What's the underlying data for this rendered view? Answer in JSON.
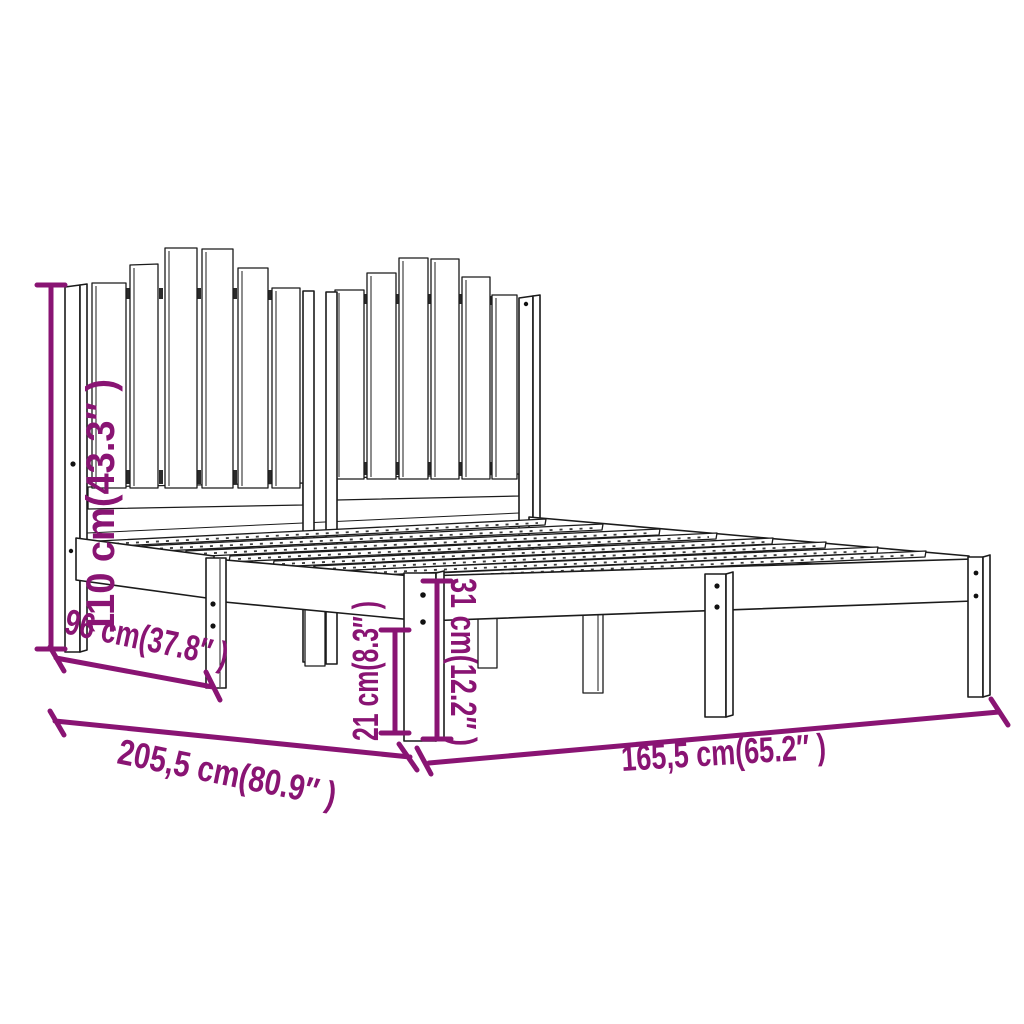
{
  "diagram": {
    "kind": "furniture-dimension-line-drawing",
    "subject": "wooden bed frame with two-section picket slat headboard",
    "background_color": "#ffffff",
    "outline_color": "#1b1b1b",
    "dimension_color": "#891473",
    "dimensions": {
      "headboard_height": {
        "label": "110 cm(43.3″ )",
        "cm": "110",
        "inches": "43.3",
        "orientation": "vertical-left"
      },
      "side_depth": {
        "label": "96 cm(37.8″ )",
        "cm": "96",
        "inches": "37.8",
        "orientation": "diagonal-lower-left"
      },
      "frame_length": {
        "label": "205,5 cm(80.9″ )",
        "cm": "205,5",
        "inches": "80.9",
        "orientation": "diagonal-bottom-left"
      },
      "leg_height": {
        "label": "21 cm(8.3″ )",
        "cm": "21",
        "inches": "8.3",
        "orientation": "vertical-center"
      },
      "platform_height": {
        "label": "31 cm(12.2″ )",
        "cm": "31",
        "inches": "12.2",
        "orientation": "vertical-center"
      },
      "frame_width": {
        "label": "165,5 cm(65.2″ )",
        "cm": "165,5",
        "inches": "65.2",
        "orientation": "horizontal-bottom-right"
      }
    }
  }
}
